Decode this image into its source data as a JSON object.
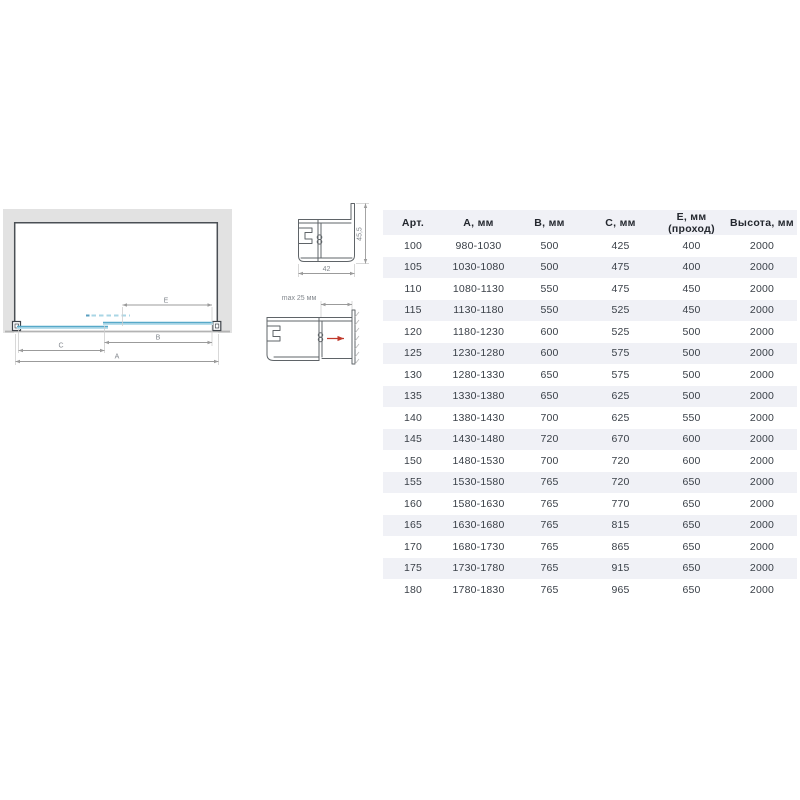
{
  "colors": {
    "stripe": "#f0f1f6",
    "wall": "#e2e2e2",
    "glass": "#57a9c9",
    "glassLight": "#b8dfec",
    "glassDash": "#a9d6e5",
    "arrowRed": "#c0392b",
    "dimension": "#9b9b9b",
    "text": "#3a4048"
  },
  "diagram": {
    "labels": {
      "a": "A",
      "b": "B",
      "c": "C",
      "e": "E"
    }
  },
  "profile_top": {
    "width_label": "42",
    "height_label": "45,5"
  },
  "profile_bottom": {
    "max_label": "max 25 мм"
  },
  "table": {
    "headers": [
      "Арт.",
      "А, мм",
      "В, мм",
      "С, мм",
      "Е, мм (проход)",
      "Высота, мм"
    ],
    "rows": [
      [
        "100",
        "980-1030",
        "500",
        "425",
        "400",
        "2000"
      ],
      [
        "105",
        "1030-1080",
        "500",
        "475",
        "400",
        "2000"
      ],
      [
        "110",
        "1080-1130",
        "550",
        "475",
        "450",
        "2000"
      ],
      [
        "115",
        "1130-1180",
        "550",
        "525",
        "450",
        "2000"
      ],
      [
        "120",
        "1180-1230",
        "600",
        "525",
        "500",
        "2000"
      ],
      [
        "125",
        "1230-1280",
        "600",
        "575",
        "500",
        "2000"
      ],
      [
        "130",
        "1280-1330",
        "650",
        "575",
        "500",
        "2000"
      ],
      [
        "135",
        "1330-1380",
        "650",
        "625",
        "500",
        "2000"
      ],
      [
        "140",
        "1380-1430",
        "700",
        "625",
        "550",
        "2000"
      ],
      [
        "145",
        "1430-1480",
        "720",
        "670",
        "600",
        "2000"
      ],
      [
        "150",
        "1480-1530",
        "700",
        "720",
        "600",
        "2000"
      ],
      [
        "155",
        "1530-1580",
        "765",
        "720",
        "650",
        "2000"
      ],
      [
        "160",
        "1580-1630",
        "765",
        "770",
        "650",
        "2000"
      ],
      [
        "165",
        "1630-1680",
        "765",
        "815",
        "650",
        "2000"
      ],
      [
        "170",
        "1680-1730",
        "765",
        "865",
        "650",
        "2000"
      ],
      [
        "175",
        "1730-1780",
        "765",
        "915",
        "650",
        "2000"
      ],
      [
        "180",
        "1780-1830",
        "765",
        "965",
        "650",
        "2000"
      ]
    ]
  }
}
